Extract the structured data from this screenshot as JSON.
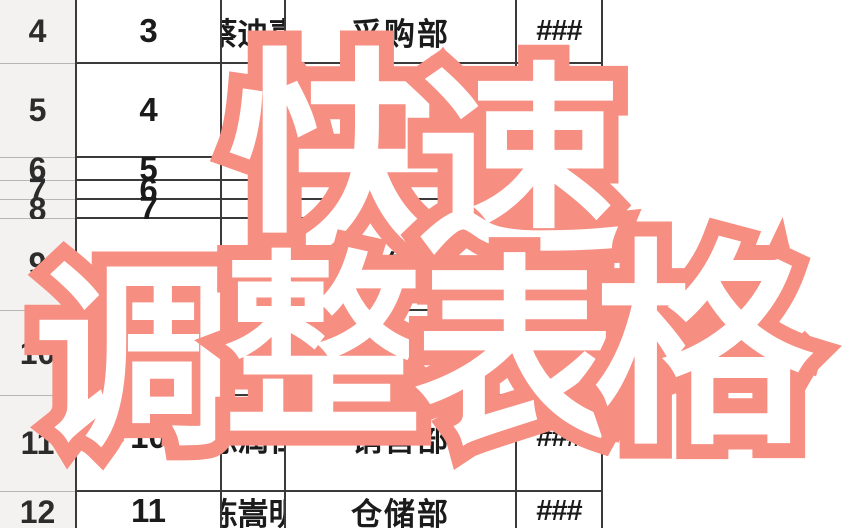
{
  "overlay": {
    "line1": "快速",
    "line2": "调整表格",
    "chars": [
      "快",
      "速",
      "调",
      "整",
      "表",
      "格"
    ],
    "fill_color": "#ffffff",
    "outline_color": "#f68e82"
  },
  "sheet": {
    "grid_border_color": "#3a3a3a",
    "row_header_bg": "#f3f2f1",
    "rows": [
      {
        "row": "4",
        "seq": "3",
        "name": "蔡迪嘉",
        "dept": "采购部",
        "value": "###"
      },
      {
        "row": "5",
        "seq": "4",
        "name": "",
        "dept": "",
        "value": ""
      },
      {
        "row": "6",
        "seq": "5",
        "name": "",
        "dept": "",
        "value": ""
      },
      {
        "row": "7",
        "seq": "6",
        "name": "",
        "dept": "",
        "value": ""
      },
      {
        "row": "8",
        "seq": "7",
        "name": "",
        "dept": "",
        "value": ""
      },
      {
        "row": "9",
        "seq": "8",
        "name": "",
        "dept": "销售部",
        "value": "###"
      },
      {
        "row": "10",
        "seq": "",
        "name": "",
        "dept": "",
        "value": ""
      },
      {
        "row": "11",
        "seq": "10",
        "name": "陈润仁",
        "dept": "销售部",
        "value": "###"
      },
      {
        "row": "12",
        "seq": "11",
        "name": "陈嵩明",
        "dept": "仓储部",
        "value": "###"
      }
    ]
  }
}
